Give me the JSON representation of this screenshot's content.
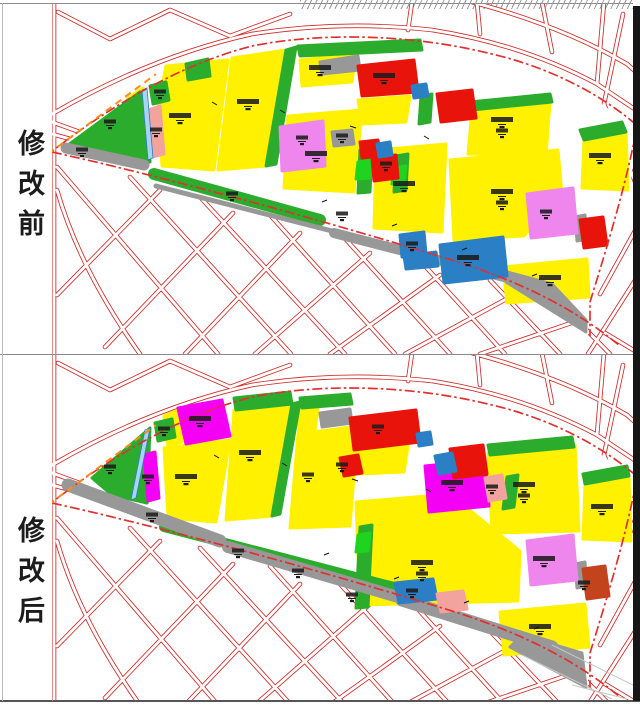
{
  "sidebar": {
    "before_label": "修改前",
    "after_label": "修改后"
  },
  "panels": {
    "before": {
      "name": "修改前 land-use plan (before modification)"
    },
    "after": {
      "name": "修改后 land-use plan (after modification)"
    }
  },
  "colors": {
    "yellow": "#FFF100",
    "green": "#2CAC2C",
    "green2": "#1FD41F",
    "red": "#E8130B",
    "darkred": "#C2431C",
    "magenta": "#F400F4",
    "violet": "#EE86EE",
    "salmon": "#F2A39E",
    "blue": "#2B7FC4",
    "lblue": "#A8D4F2",
    "gray": "#989898",
    "roadline": "#CD2A28",
    "dash": "#E03030",
    "orange": "#FF8C1A",
    "frame": "#8A8A8A",
    "black": "#161616",
    "hatch": "#9A9A9A",
    "ink": "#1C1C1C"
  }
}
